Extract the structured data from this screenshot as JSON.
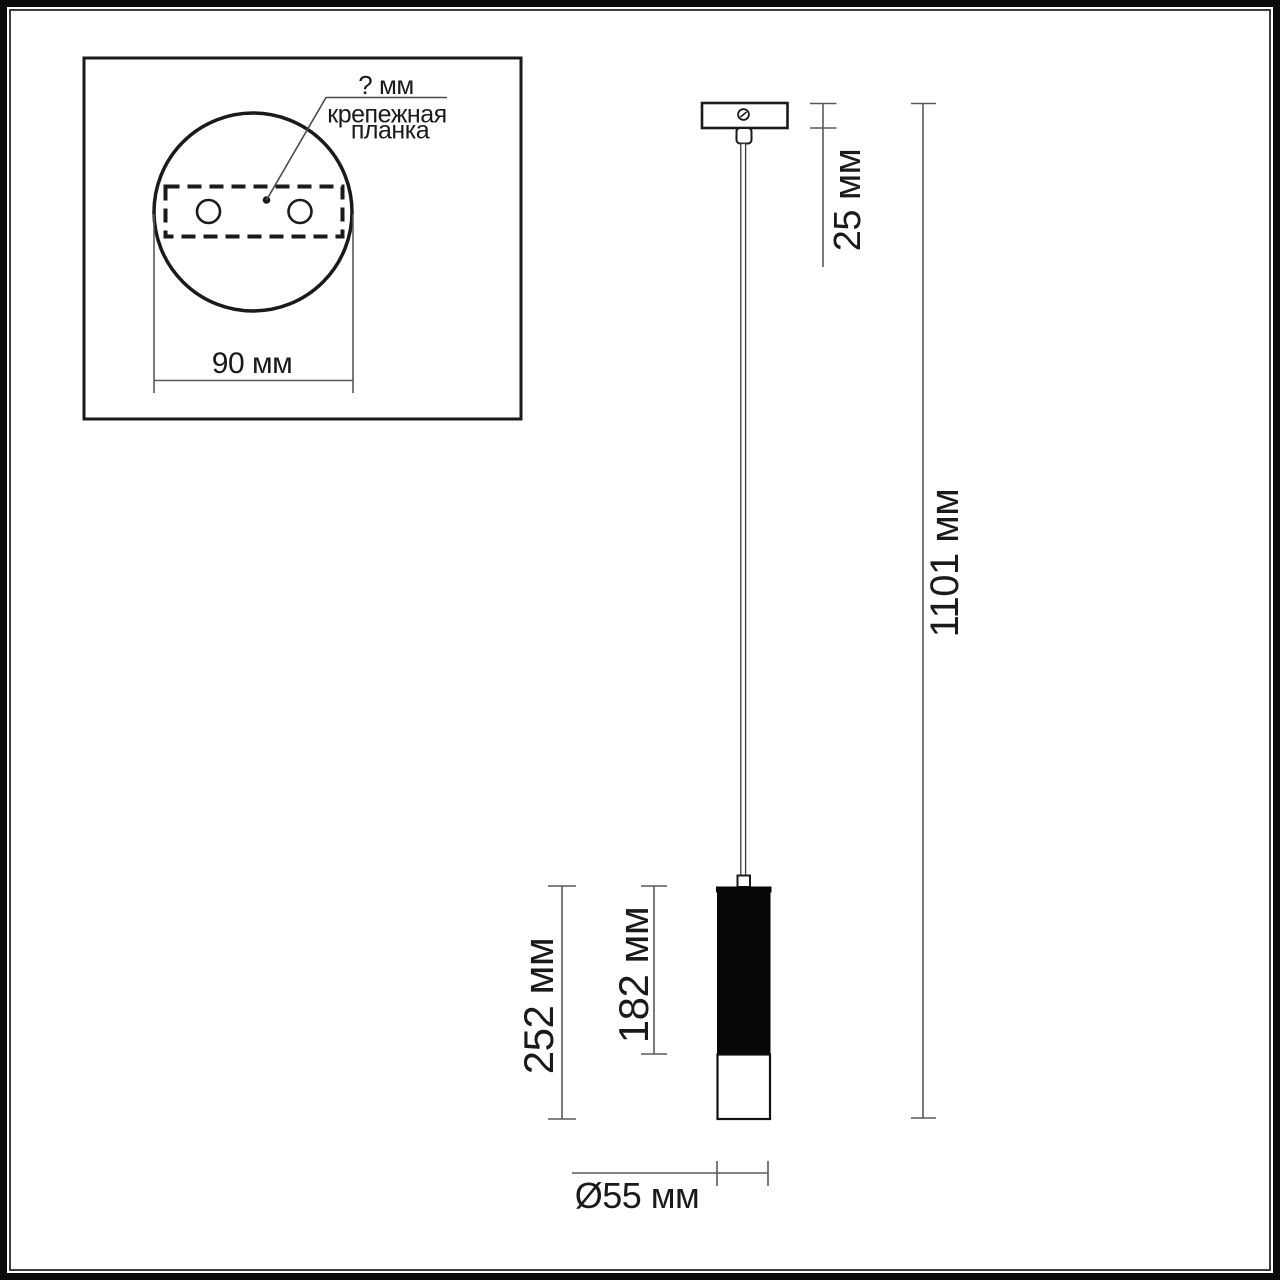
{
  "inset_detail": {
    "hole_spacing_label": "? мм",
    "mount_plate_label_line1": "крепежная",
    "mount_plate_label_line2": "планка",
    "base_width_label": "90 мм"
  },
  "dimension_labels": {
    "canopy_offset": "25 мм",
    "overall_height": "1101 мм",
    "shade_overall_height": "252 мм",
    "shade_black_section_height": "182 мм",
    "shade_diameter": "Ø55 мм"
  },
  "colors": {
    "background": "#ffffff",
    "drawing_line": "#1a1a1a",
    "dimension_line": "#5a5a5a",
    "lamp_body_fill": "#070707",
    "frame_outer": "#0a0a0a",
    "frame_inner": "#3d3d3d"
  }
}
